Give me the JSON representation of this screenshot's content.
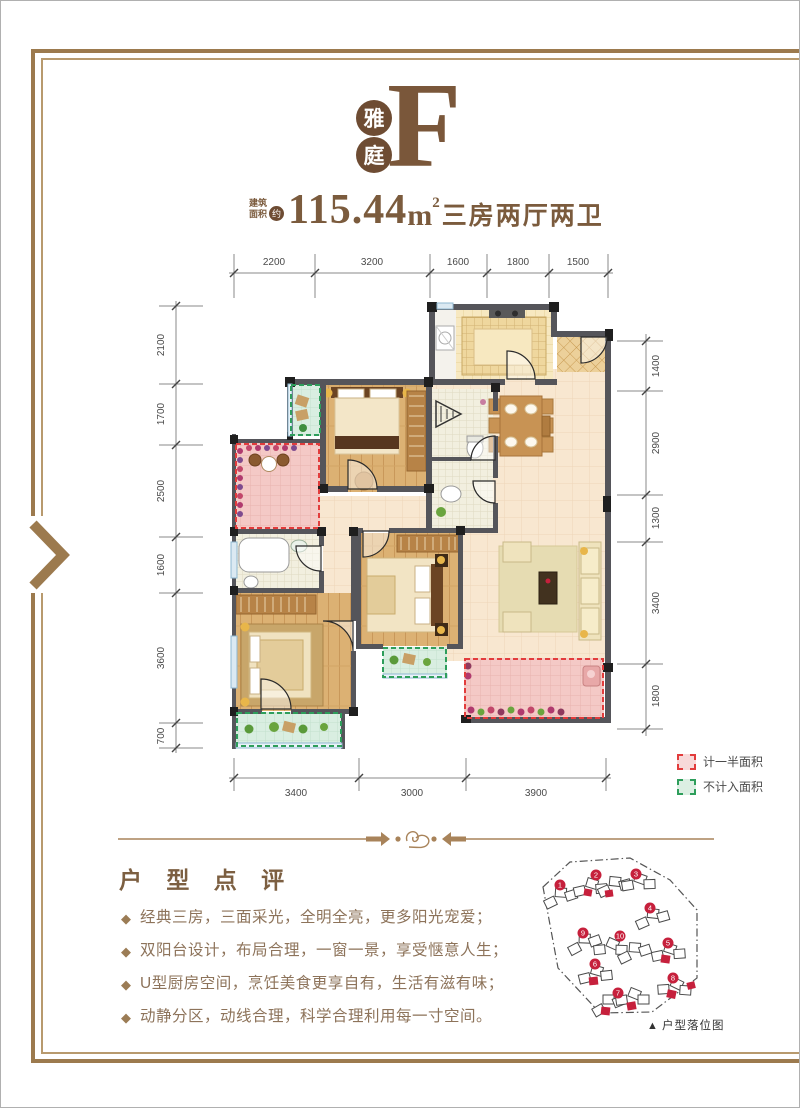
{
  "header": {
    "logo_char_top": "雅",
    "logo_char_bottom": "庭",
    "unit_letter": "F",
    "area_label_line1": "建筑",
    "area_label_line2": "面积",
    "area_approx": "约",
    "area_value": "115.44",
    "area_unit_base": "m",
    "area_unit_sup": "2",
    "layout_text": "三房两厅两卫"
  },
  "plan": {
    "dims_top": [
      "2200",
      "3200",
      "1600",
      "1800",
      "1500"
    ],
    "dims_left": [
      "2100",
      "1700",
      "2500",
      "1600",
      "3600",
      "700"
    ],
    "dims_right": [
      "1400",
      "2900",
      "1300",
      "3400",
      "1800"
    ],
    "dims_bottom": [
      "3400",
      "3000",
      "3900"
    ],
    "legend": [
      {
        "label": "计一半面积",
        "color": "#e23c3c"
      },
      {
        "label": "不计入面积",
        "color": "#2e9e5b"
      }
    ]
  },
  "review": {
    "title": "户 型 点 评",
    "bullet": "◆",
    "items": [
      "经典三房，三面采光，全明全亮，更多阳光宠爱；",
      "双阳台设计，布局合理，一窗一景，享受惬意人生；",
      "U型厨房空间，烹饪美食更享自有，生活有滋有味；",
      "动静分区，动线合理，科学合理利用每一寸空间。"
    ]
  },
  "siteplan": {
    "caption_marker": "▲",
    "caption": "户型落位图",
    "building_numbers": [
      "1",
      "2",
      "3",
      "4",
      "5",
      "6",
      "7",
      "8",
      "9",
      "10"
    ]
  },
  "colors": {
    "accent_brown": "#7b5b3d",
    "frame_brown": "#9c7a4e",
    "half_area_red": "#e23c3c",
    "excluded_green": "#2e9e5b",
    "siteplan_red": "#c6203c"
  }
}
